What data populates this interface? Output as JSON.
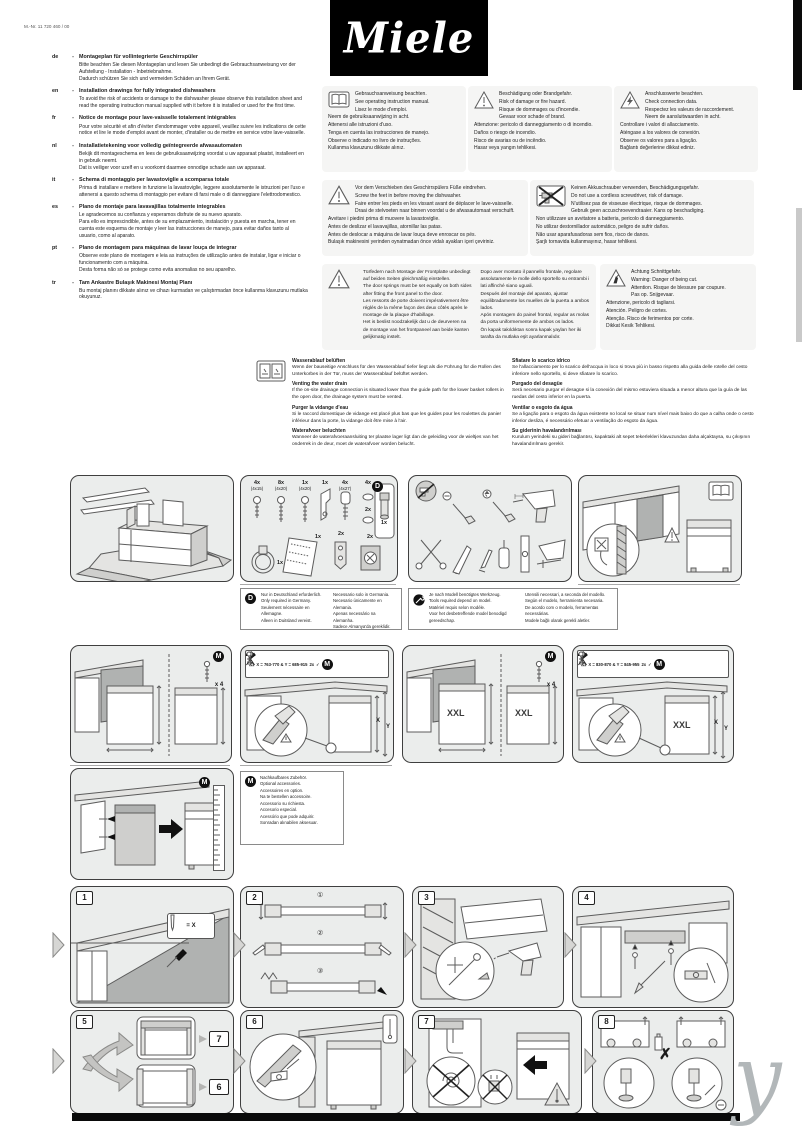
{
  "page": {
    "mat_no": "M.-Nr. 11 720 460 / 00",
    "brand": "Miele",
    "watermark": "y"
  },
  "intro": {
    "sep": "-",
    "entries": [
      {
        "code": "de",
        "title": "Montageplan für vollintegrierte Geschirrspüler",
        "body": "Bitte beachten Sie diesen Montageplan und lesen Sie unbedingt die Gebrauchsanweisung vor der Aufstellung - Installation - Inbetriebnahme.\nDadurch schützen Sie sich und vermeiden Schäden an Ihrem Gerät."
      },
      {
        "code": "en",
        "title": "Installation drawings for fully integrated dishwashers",
        "body": "To avoid the risk of accidents or damage to the dishwasher please observe this installation sheet and read the operating instruction manual supplied with it before it is installed or used for the first time."
      },
      {
        "code": "fr",
        "title": "Notice de montage pour lave-vaisselle totalement intégrables",
        "body": "Pour votre sécurité et afin d'éviter d'endommager votre appareil, veuillez suivre les indications de cette notice et lire le mode d'emploi avant de monter, d'installer ou de mettre en service votre lave-vaisselle."
      },
      {
        "code": "nl",
        "title": "Installatietekening voor volledig geïntegreerde afwasautomaten",
        "body": "Bekijk dit montageschema en lees de gebruiksaanwijzing voordat u uw apparaat plaatst, installeert en in gebruik neemt.\nDat is veiliger voor uzelf en u voorkomt daarmee onnodige schade aan uw apparaat."
      },
      {
        "code": "it",
        "title": "Schema di montaggio per lavastoviglie a scomparsa totale",
        "body": "Prima di installare e mettere in funzione la lavastoviglie, leggere assolutamente le istruzioni per l'uso e attenersi a questo schema di montaggio per evitare di farsi male o di danneggiare l'elettrodomestico."
      },
      {
        "code": "es",
        "title": "Plano de montaje para lavavajillas totalmente integrables",
        "body": "Le agradecemos su confianza y esperamos disfrute de su nuevo aparato.\nPara ello es imprescindible, antes de su emplazamiento, instalación y puesta en marcha, tener en cuenta este esquema de montaje y leer las instrucciones de manejo, para evitar daños tanto al usuario, como al aparato."
      },
      {
        "code": "pt",
        "title": "Plano de montagem para máquinas de lavar louça de integrar",
        "body": "Observe este plano de montagem e leia as instruções de utilização antes de instalar, ligar e iniciar o funcionamento com a máquina.\nDesta forma não só se protege como evita anomalias no seu aparelho."
      },
      {
        "code": "tr",
        "title": "Tam Ankastre Bulaşık Makinesi Montaj Planı",
        "body": "Bu montaj planını dikkate alınız ve cihazı kurmadan ve çalıştırmadan önce kullanma klavuzunu mutlaka okuyunuz."
      }
    ]
  },
  "notices": {
    "observe_manual": [
      "Gebrauchsanweisung beachten.",
      "See operating instruction manual.",
      "Lisez le mode d'emploi.",
      "Neem de gebruiksaanwijzing in acht.",
      "Attenersi alle istruzioni d'uso.",
      "Tenga en cuenta las instrucciones de manejo.",
      "Observe o indicado no livro de instruções.",
      "Kullanma klavuzunu dikkate alınız."
    ],
    "fire_hazard": [
      "Beschädigung oder Brandgefahr.",
      "Risk of damage or fire hazard.",
      "Risque de dommages ou d'incendie.",
      "Gevaar voor schade of brand.",
      "Attenzione: pericolo di danneggiamento o di incendio.",
      "Daños o riesgo de incendio.",
      "Risco de avarias ou de incêndio.",
      "Hasar veya yangın tehlikesi."
    ],
    "connection_data": [
      "Anschlusswerte beachten.",
      "Check connection data.",
      "Respectez les valeurs de raccordement.",
      "Neem de aansluitwaarden in acht.",
      "Controllare i valori di allacciamento.",
      "Aténgase a los valores de conexión.",
      "Observe os valores para a ligação.",
      "Bağlantı değerlerine dikkat ediniz."
    ],
    "screw_feet": [
      "Vor dem Verschieben des Geschirrspülers Füße eindrehen.",
      "Screw the feet in before moving the dishwasher.",
      "Faire entrer les pieds en les vissant avant de déplacer le lave-vaisselle.",
      "Draai de stelvoeten naar binnen voordat u de afwasautomaat verschuift.",
      "Avvitare i piedini prima di muovere la lavastoviglie.",
      "Antes de deslizar el lavavajillas, atornillar las patas.",
      "Antes de deslocar a máquina de lavar louça deve enroscar os pés.",
      "Bulaşık makinesini yerinden oynatmadan önce vidalı ayakları içeri çeviriniz."
    ],
    "no_cordless": [
      "Keinen Akkuschrauber verwenden, Beschädigungsgefahr.",
      "Do not use a cordless screwdriver, risk of damage.",
      "N'utilisez pas de visseuse électrique, risque de dommages.",
      "Gebruik geen accuschroevendraaier. Kans op beschadiging.",
      "Non utilizzare un avvitatore a batteria, pericolo di danneggiamento.",
      "No utilizar destornillador automático, peligro de sufrir daños.",
      "Não usar aparafusadoras sem fios, risco de danos.",
      "Şarjlı tornavida kullanmayınız, hasar tehlikesi."
    ],
    "door_springs_col1": [
      "Türfedern nach Montage der Frontplatte unbedingt auf beiden Seiten gleichmäßig einstellen.",
      "The door springs must be set equally on both sides after fitting the front panel to the door.",
      "Les ressorts de porte doivent impérativement être réglés de la même façon des deux côtés après le montage de la plaque d'habillage.",
      "Het is beslist noodzakelijk dat u de deurveren na de montage van het frontpaneel aan beide kanten gelijkmatig instelt."
    ],
    "door_springs_col2": [
      "Dopo aver montato il pannello frontale, regolare assolutamente le molle dello sportello su entrambi i lati affinché siano uguali.",
      "Después del montaje del aparato, ajustar equilibradamente los muelles de la puerta a ambos lados.",
      "Após montagem do painel frontal, regular as molas da porta uniformemente de ambos os lados.",
      "Ön kapak takıldıktan sonra kapak yayları her iki tarafta da mutlaka eşit ayarlanmalıdır."
    ],
    "cut_hazard": [
      "Achtung Schnittgefahr.",
      "Warning: Danger of being cut.",
      "Attention. Risque de blessure par coupure.",
      "Pas op. Snijgevaar.",
      "Attenzione, pericolo di tagliarsi.",
      "Atención. Peligro de cortes.",
      "Atenção. Risco de ferimentos por corte.",
      "Dikkat Kesik Tehlikesi."
    ]
  },
  "venting": {
    "left": [
      {
        "heading": "Wasserablauf belüften",
        "body": "Wenn der bauseitige Anschluss für den Wasserablauf tiefer liegt als die Führung für die Rollen des Unterkorbes in der Tür, muss der Wasserablauf belüftet werden."
      },
      {
        "heading": "Venting the water drain",
        "body": "If the on-site drainage connection is situated lower than the guide path for the lower basket rollers in the open door, the drainage system must be vented."
      },
      {
        "heading": "Purger la vidange d'eau",
        "body": "Si le raccord domestique de vidange est placé plus bas que les guides pour les roulettes du panier inférieur dans la porte, la vidange doit être mise à l'air."
      },
      {
        "heading": "Waterafvoer beluchten",
        "body": "Wanneer de waterafvoeraansluiting ter plaatse lager ligt dan de geleiding voor de wieltjes van het onderrek in de deur, moet de waterafvoer worden belucht."
      }
    ],
    "right": [
      {
        "heading": "Sfiatare lo scarico idrico",
        "body": "Se l'allacciamento per lo scarico dell'acqua in loco si trova più in basso rispetto alla guida delle rotelle del cesto inferiore nello sportello, si deve sfiatare lo scarico."
      },
      {
        "heading": "Purgado del desagüe",
        "body": "Será necesario purgar el desagüe si la conexión del mismo estuviera situada a menor altura que la guía de las ruedas del cesto inferior en la puerta."
      },
      {
        "heading": "Ventilar o esgoto da água",
        "body": "Se a ligação para o esgoto da água existente no local se situar num nível mais baixo do que a calha onde o cesto inferior desliza, é necessário efetuar a ventilação do esgoto da água."
      },
      {
        "heading": "Su giderinin havalandırılması",
        "body": "Kurulum yerindeki su gideri bağlantısı, kapaktaki alt sepet tekerlekleri klavuzundan daha alçaktaysa, su çıkışının havalandırılması gerekir."
      }
    ]
  },
  "parts": {
    "badge": "D",
    "screw1_qty": "4x",
    "screw1_size": "(4x15)",
    "screw2_qty": "8x",
    "screw2_size": "(4x20)",
    "screw3_qty": "1x",
    "screw3_size": "(4x20)",
    "bracket_qty": "1x",
    "plug_qty": "4x",
    "plug_size": "(4x27)",
    "cap1_qty": "4x",
    "cap2_qty": "2x",
    "dbox_qty": "1x",
    "clamp_qty": "1x",
    "sheet_qty": "1x",
    "holder_qty": "2x",
    "sieve_qty": "2x"
  },
  "region_note": {
    "badge": "D",
    "col1": [
      "Nur in Deutschland erforderlich.",
      "Only required in Germany.",
      "Seulement nécessaire en Allemagne.",
      "Alleen in Duitsland vereist."
    ],
    "col2": [
      "Necessario solo in Germania.",
      "Necesario únicamente en Alemania.",
      "Apenas necessário na Alemanha.",
      "Sadece Almanya'da gereklidir."
    ]
  },
  "tools_note": {
    "col1": [
      "Je nach Modell benötigtes Werkzeug.",
      "Tools required depend on model.",
      "Matériel requis selon modèle.",
      "Voor het desbetreffende model benodigd gereedschap."
    ],
    "col2": [
      "Utensili necessari, a seconda del modello.",
      "Según el modelo, herramienta necesaria.",
      "De acordo com o modelo, ferramentas necessárias.",
      "Modele bağlı olarak gerekli aletler."
    ]
  },
  "install": {
    "m_badge": "M",
    "x4": "x 4",
    "xxl": "XXL",
    "standard_dims": "X = 763-770 & Y = 685-915",
    "xxl_dims": "X = 830-870 & Y = 845-955",
    "reject_qty": "2x",
    "check": "✓",
    "cross": "✗",
    "warn": "⚠",
    "dim_x": "X",
    "dim_y": "Y",
    "accessory": [
      "Nachkaufbares Zubehör.",
      "Optional accessories.",
      "Accessoires en option.",
      "Na te bestellen accessoire.",
      "Accessorio su richiesta.",
      "Accesorio especial.",
      "Acessório que pode adquirir.",
      "Sonradan alınabilen aksesuar."
    ]
  },
  "steps": {
    "n1": "1",
    "n2": "2",
    "n3": "3",
    "n4": "4",
    "n5": "5",
    "n6": "6",
    "n7": "7",
    "n8": "8",
    "ref7": "7",
    "ref6": "6",
    "sub1": "①",
    "sub2": "②",
    "sub3": "③",
    "inset1": "= X"
  }
}
